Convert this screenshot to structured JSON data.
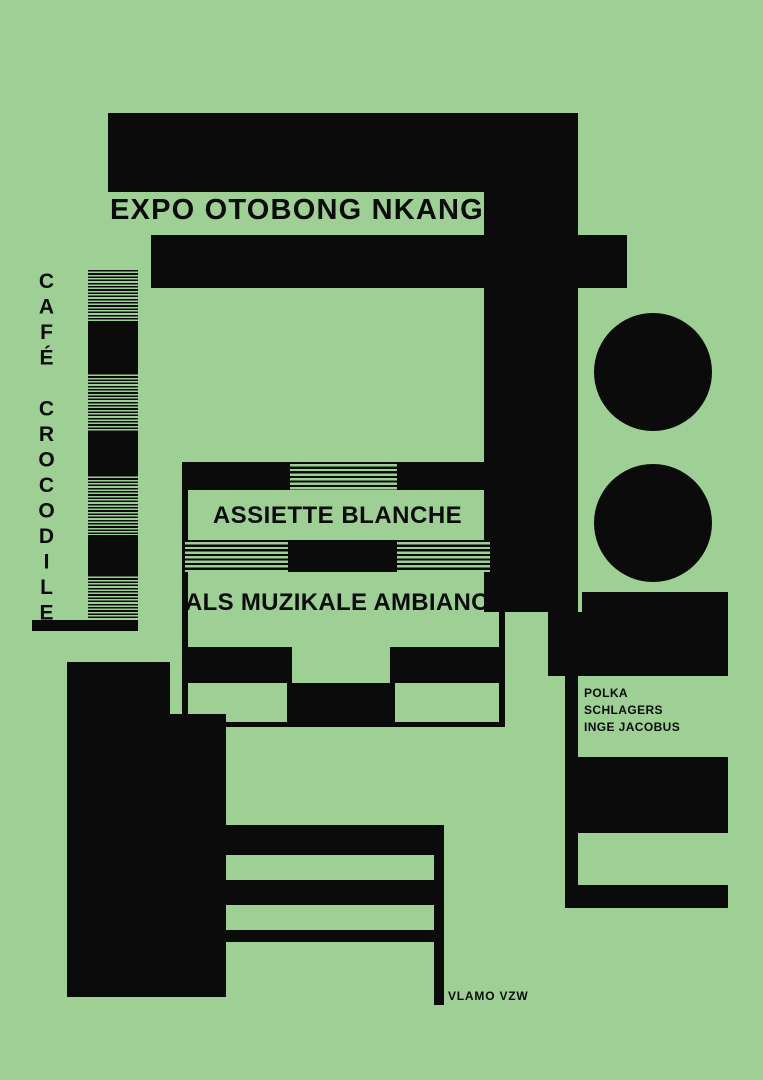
{
  "colors": {
    "bg": "#9ed096",
    "ink": "#0b0b0b"
  },
  "poster": {
    "expo_title": "EXPO OTOBONG NKANGA",
    "cafe_vertical": "CAFÉ CROCODILE",
    "assiette_label": "ASSIETTE BLANCHE",
    "ambiance_label": "ALS MUZIKALE AMBIANCE",
    "program": [
      "POLKA",
      "SCHLAGERS",
      "INGE JACOBUS"
    ],
    "credit": "VLAMO VZW"
  }
}
